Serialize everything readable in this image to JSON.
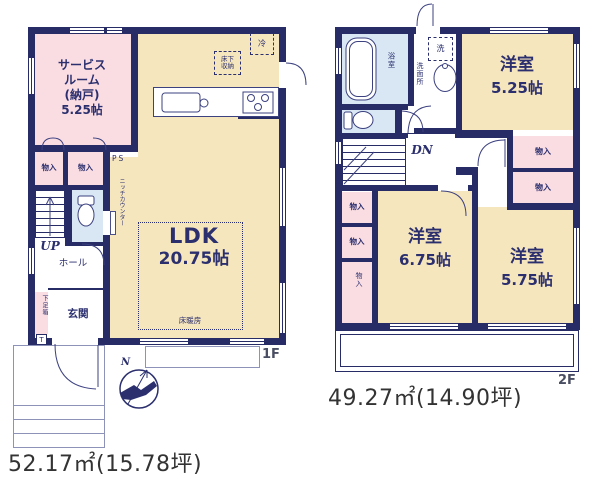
{
  "floor1": {
    "floor_label": "1F",
    "area_text": "52.17㎡(15.78坪)",
    "compass_label": "N",
    "rooms": {
      "service_room_lines": [
        "サービス",
        "ルーム",
        "(納戸)",
        "5.25帖"
      ],
      "ldk_name": "LDK",
      "ldk_size": "20.75帖",
      "hall": "ホール",
      "entrance": "玄関",
      "closet_a": "物入",
      "closet_b": "物入",
      "shoe_box": "下足箱",
      "shoe_box_t": "T",
      "stairs_label": "UP",
      "ps_label": "PS",
      "niche_counter": "ニッチカウンター",
      "floor_heating": "床暖房",
      "underfloor_storage_lines": [
        "床下",
        "収納"
      ],
      "refrigerator": "冷"
    }
  },
  "floor2": {
    "floor_label": "2F",
    "area_text": "49.27㎡(14.90坪)",
    "rooms": {
      "bathroom": "浴室",
      "washroom": "洗面所",
      "washer": "洗",
      "room_a_name": "洋室",
      "room_a_size": "5.25帖",
      "room_b_name": "洋室",
      "room_b_size": "6.75帖",
      "room_c_name": "洋室",
      "room_c_size": "5.75帖",
      "closet_a": "物入",
      "closet_b": "物入",
      "closet_c": "物入",
      "closet_d": "物入",
      "closet_e": "物入",
      "stairs_label": "DN"
    }
  }
}
